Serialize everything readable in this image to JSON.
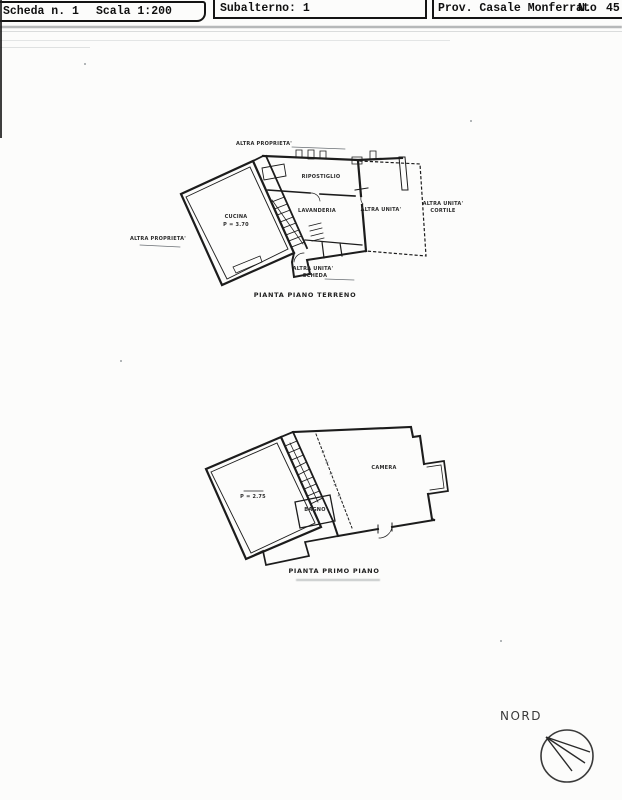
{
  "header": {
    "scheda": "Scheda n. 1",
    "scala": "Scala 1:200",
    "subalterno": "Subalterno: 1",
    "provincia": "Prov. Casale Monferrato",
    "numero_label": "N.",
    "numero_value": "45"
  },
  "ground_floor": {
    "caption": "PIANTA PIANO TERRENO",
    "labels": {
      "altra_proprieta_top": "ALTRA PROPRIETA'",
      "altra_proprieta_left": "ALTRA PROPRIETA'",
      "ripostiglio": "RIPOSTIGLIO",
      "lavanderia": "LAVANDERIA",
      "room_left_name": "CUCINA",
      "room_left_height": "P = 3.70",
      "altra_unita": "ALTRA UNITA'",
      "cortile_line1": "ALTRA UNITA'",
      "cortile_line2": "CORTILE",
      "scheda_line1": "ALTRA UNITA'",
      "scheda_line2": "SCHEDA"
    }
  },
  "first_floor": {
    "caption": "PIANTA PRIMO PIANO",
    "labels": {
      "room_left_height": "P = 2.75",
      "bagno": "BAGNO",
      "camera": "CAMERA"
    }
  },
  "compass": {
    "north_label": "NORD"
  },
  "colors": {
    "ink": "#1c1c1c",
    "faint": "#8d9296",
    "paper": "#fcfcfb"
  }
}
